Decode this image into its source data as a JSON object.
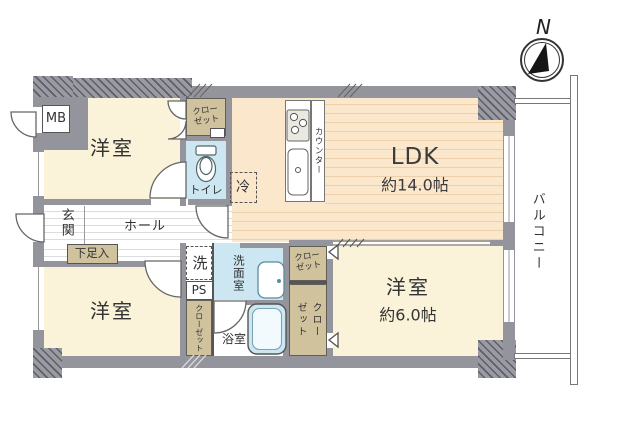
{
  "plan": {
    "compass_label": "N",
    "balcony_label": "バルコニー",
    "ldk": {
      "label": "LDK",
      "size": "約14.0帖"
    },
    "bedroom_top_left": {
      "label": "洋室"
    },
    "bedroom_bottom_left": {
      "label": "洋室"
    },
    "bedroom_bottom_right": {
      "label": "洋室",
      "size": "約6.0帖"
    },
    "entrance_label": "玄関",
    "hall_label": "ホール",
    "shoebox_label": "下足入",
    "toilet_label": "トイレ",
    "washroom_label": "洗面室",
    "bathroom_label": "浴室",
    "washer_label": "洗",
    "ps_label": "PS",
    "mb_label": "MB",
    "fridge_label": "冷",
    "counter_label": "カウンター",
    "closet_top": "クロー\nゼット",
    "closet_washroom_side": "クロー\nゼット",
    "closet_bedroom3": "クロー\nゼット",
    "closet_bathroom_side": "クローゼット"
  },
  "colors": {
    "wall": "#94949c",
    "room_cream": "#faf3d9",
    "ldk_peach": "#fbe7cb",
    "closet_tan": "#cfc29c",
    "wet_blue": "#cce7f2",
    "line_dark": "#555555"
  }
}
